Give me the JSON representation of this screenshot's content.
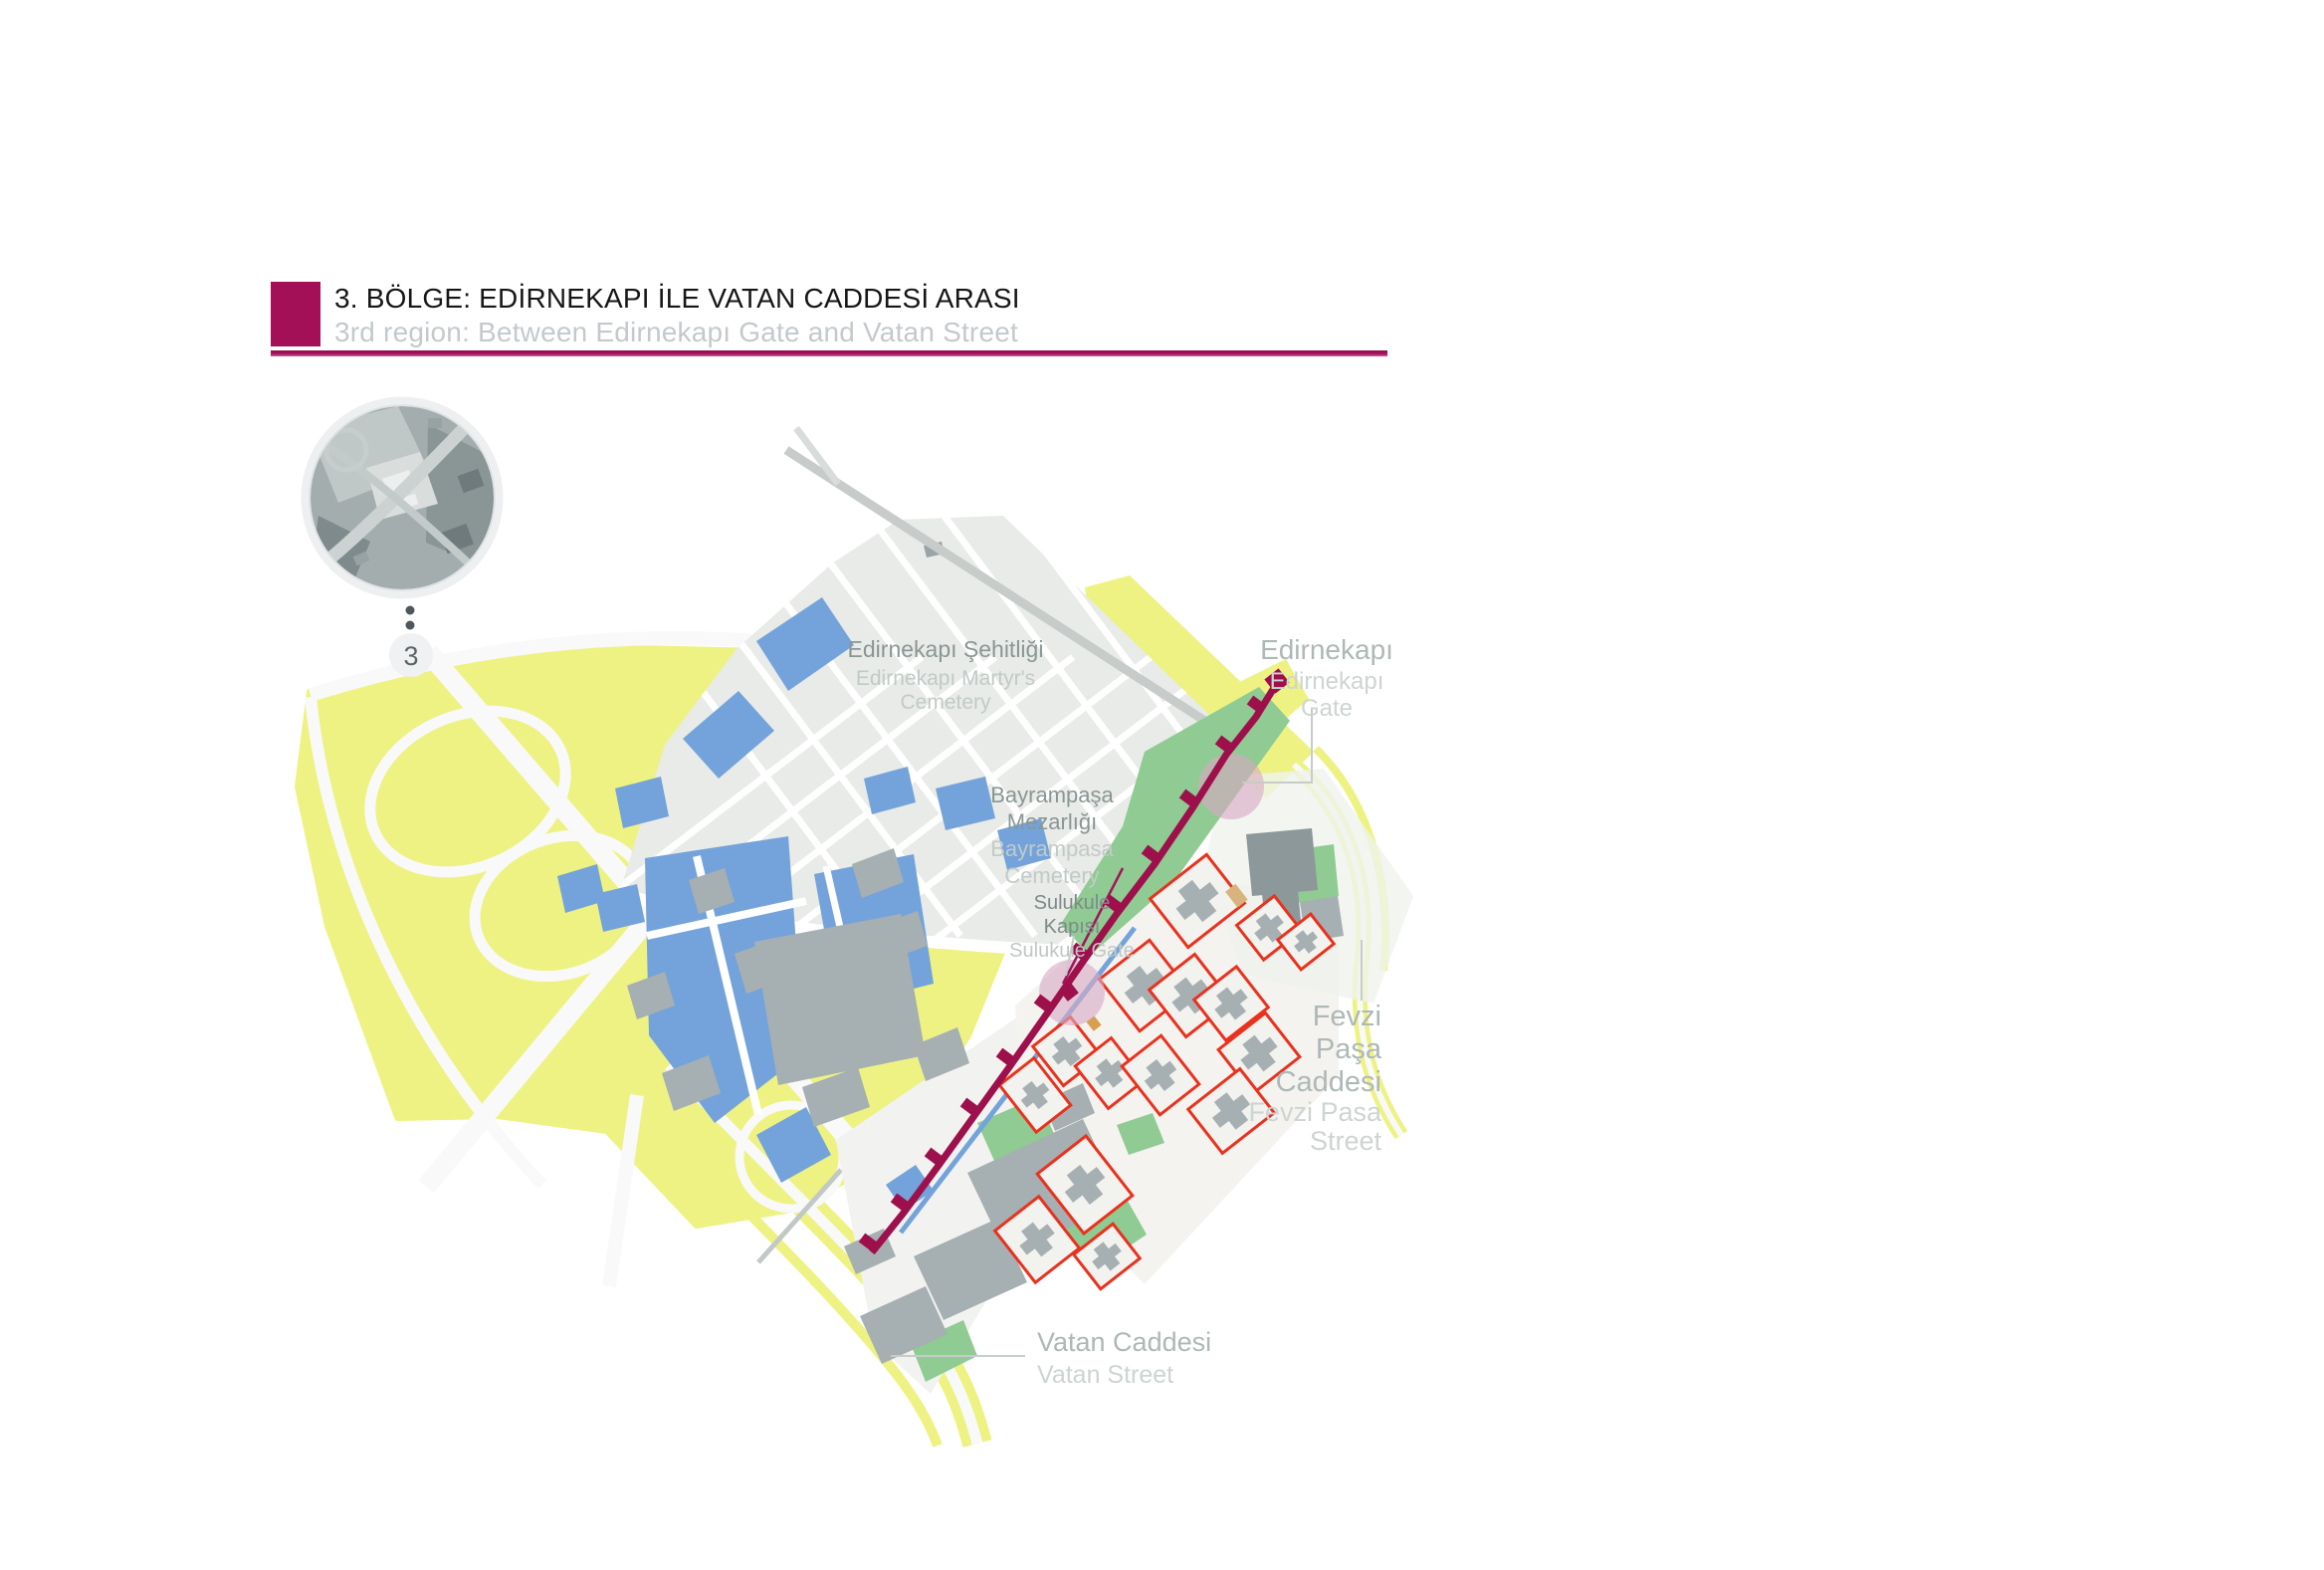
{
  "header": {
    "title_tr": "3. BÖLGE: EDİRNEKAPI İLE VATAN CADDESİ ARASI",
    "title_en": "3rd region: Between Edirnekapı Gate and Vatan Street"
  },
  "region_indicator": {
    "number": "3"
  },
  "map": {
    "labels": {
      "edirnekapi_sehitligi": {
        "tr": "Edirnekapı Şehitliği",
        "en_line1": "Edirnekapı Martyr's",
        "en_line2": "Cemetery"
      },
      "bayrampasa": {
        "tr_line1": "Bayrampaşa",
        "tr_line2": "Mezarlığı",
        "en_line1": "Bayrampasa",
        "en_line2": "Cemetery"
      },
      "sulukule": {
        "tr_line1": "Sulukule",
        "tr_line2": "Kapısı",
        "en": "Sulukule Gate"
      },
      "edirnekapi_gate": {
        "tr": "Edirnekapı",
        "en_line1": "Edirnekapı",
        "en_line2": "Gate"
      },
      "fevzi_pasa": {
        "tr_line1": "Fevzi",
        "tr_line2": "Paşa",
        "tr_line3": "Caddesi",
        "en_line1": "Fevzi Pasa",
        "en_line2": "Street"
      },
      "vatan": {
        "tr": "Vatan Caddesi",
        "en": "Vatan Street"
      }
    },
    "colors": {
      "accent_magenta": "#A41058",
      "wall_magenta": "#9D104B",
      "highway_green": "#EEF283",
      "park_green": "#8FCB92",
      "building_blue": "#74A3DB",
      "building_gray": "#A6AFB2",
      "cemetery_gray": "#E8EBE7",
      "demolition_red": "#E8321E",
      "gate_pink": "#D9A9C5"
    }
  }
}
